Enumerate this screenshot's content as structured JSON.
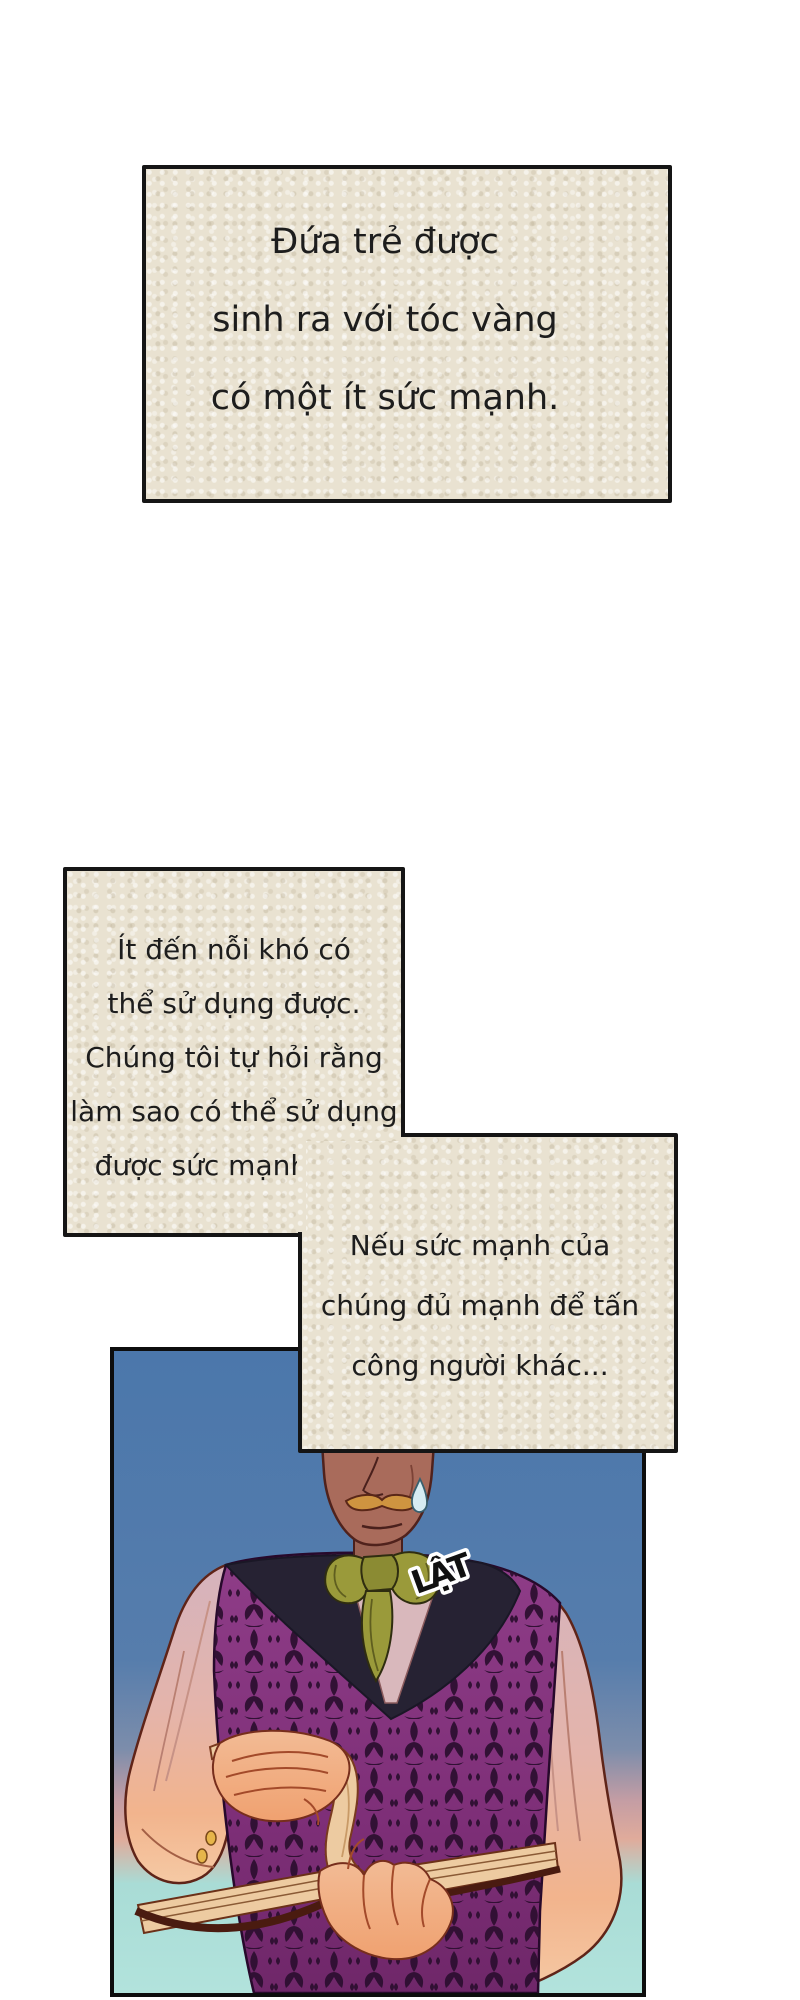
{
  "narration": {
    "box1": {
      "lines": [
        "Đứa trẻ được",
        "sinh ra với tóc vàng",
        "có một ít sức mạnh."
      ]
    },
    "box2": {
      "lines": [
        "Ít đến nỗi khó có",
        "thể sử dụng được.",
        "Chúng tôi tự hỏi rằng",
        "làm sao có thể sử dụng",
        "được sức mạnh này."
      ]
    },
    "box3": {
      "lines": [
        "Nếu sức mạnh của",
        "chúng đủ mạnh để tấn",
        "công người khác..."
      ]
    }
  },
  "sfx": {
    "text": "LẬT"
  },
  "colors": {
    "page_bg": "#ffffff",
    "note_bg": "#e9e2d1",
    "note_border": "#151515",
    "text": "#1d1d1d",
    "sky_blue": "#4b77ab",
    "horizon_pink": "#e0ab9b",
    "bottom_cyan": "#aadcd6",
    "vest_purple": "#83357c",
    "vest_motif": "#2e0f31",
    "lapel_navy": "#262233",
    "cravat_olive": "#9a9a3a",
    "face_skin": "#a96b5b",
    "hand_skin": "#f0b287",
    "sleeve_pink": "#d5b3bd",
    "book_page": "#edcba1",
    "book_cover": "#4a1b10",
    "mustache": "#cf9440"
  }
}
